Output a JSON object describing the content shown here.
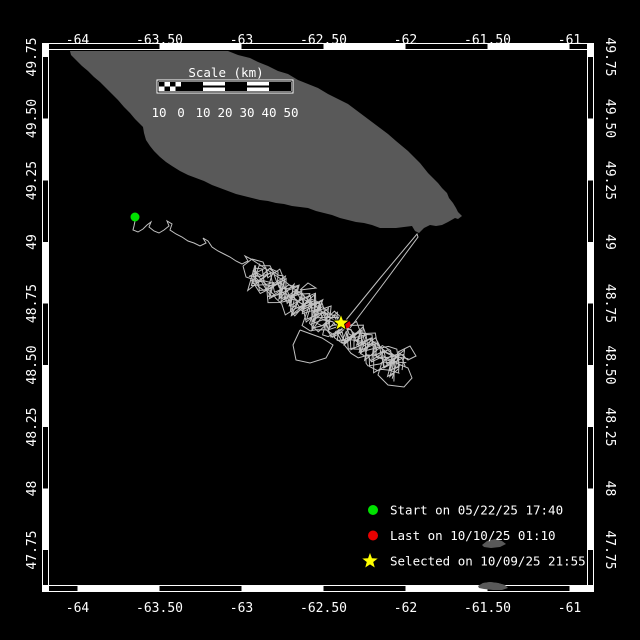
{
  "map_data": {
    "colors": {
      "background": "#000000",
      "land": "#595959",
      "track": "#c2c2c2",
      "frame_band": "#ffffff",
      "frame_seg": "#000000",
      "text": "#ffffff",
      "start_marker": "#00e100",
      "last_marker": "#e80000",
      "selected_marker": "#ffff00"
    },
    "frame": {
      "outer": {
        "x0": 42,
        "y0": 43,
        "x1": 594,
        "y1": 592
      },
      "inner": {
        "x0": 49,
        "y0": 50,
        "x1": 587,
        "y1": 585
      },
      "band_px": 7,
      "top_black_segments": [
        [
          49,
          159.5
        ],
        [
          241.5,
          323.5
        ],
        [
          405.5,
          487.5
        ],
        [
          569.5,
          587
        ]
      ],
      "bottom_black_segments": [
        [
          49,
          77.5
        ],
        [
          159.5,
          241.5
        ],
        [
          323.5,
          405.5
        ],
        [
          487.5,
          569.5
        ]
      ],
      "side_black_segments": [
        [
          57,
          118.5
        ],
        [
          180.5,
          242
        ],
        [
          303.5,
          365
        ],
        [
          427,
          488.5
        ],
        [
          550,
          585
        ]
      ]
    },
    "axis": {
      "x_ticks": [
        {
          "label": "-64",
          "x": 77.5
        },
        {
          "label": "-63.50",
          "x": 159.5
        },
        {
          "label": "-63",
          "x": 241.5
        },
        {
          "label": "-62.50",
          "x": 323.5
        },
        {
          "label": "-62",
          "x": 405.5
        },
        {
          "label": "-61.50",
          "x": 487.5
        },
        {
          "label": "-61",
          "x": 569.5
        }
      ],
      "y_ticks": [
        {
          "label": "49.75",
          "y": 57
        },
        {
          "label": "49.50",
          "y": 118.5
        },
        {
          "label": "49.25",
          "y": 180.5
        },
        {
          "label": "49",
          "y": 242
        },
        {
          "label": "48.75",
          "y": 303.5
        },
        {
          "label": "48.50",
          "y": 365
        },
        {
          "label": "48.25",
          "y": 427
        },
        {
          "label": "48",
          "y": 488.5
        },
        {
          "label": "47.75",
          "y": 550
        }
      ],
      "top_label_y": 44,
      "bottom_label_y": 612,
      "left_label_x": 36,
      "right_label_x": 606
    },
    "scalebar": {
      "title": "Scale (km)",
      "title_x": 226,
      "title_y": 77,
      "labels": [
        "10",
        "0",
        "10",
        "20",
        "30",
        "40",
        "50"
      ],
      "x0": 159,
      "step": 22,
      "bar_y": 81,
      "bar_h": 11,
      "label_y": 117
    },
    "legend": {
      "marker_x": 373,
      "text_x": 390,
      "y0": 510,
      "dy": 25.5,
      "items": [
        {
          "marker": "circle",
          "color": "#00e100",
          "label": "Start on 05/22/25 17:40"
        },
        {
          "marker": "circle",
          "color": "#e80000",
          "label": "Last on 10/10/25 01:10"
        },
        {
          "marker": "star",
          "color": "#ffff00",
          "label": "Selected on 10/09/25 21:55"
        }
      ]
    },
    "markers": {
      "start": {
        "x": 135,
        "y": 217,
        "r": 4.5
      },
      "last": {
        "x": 346,
        "y": 324,
        "r": 4.5
      },
      "selected": {
        "x": 341,
        "y": 323,
        "r": 9
      }
    },
    "island": [
      [
        70,
        51
      ],
      [
        228,
        51
      ],
      [
        238,
        55
      ],
      [
        250,
        58
      ],
      [
        258,
        62
      ],
      [
        268,
        66
      ],
      [
        278,
        71
      ],
      [
        288,
        74
      ],
      [
        298,
        80
      ],
      [
        308,
        84
      ],
      [
        318,
        88
      ],
      [
        328,
        94
      ],
      [
        338,
        99
      ],
      [
        348,
        104
      ],
      [
        356,
        110
      ],
      [
        364,
        116
      ],
      [
        372,
        122
      ],
      [
        380,
        128
      ],
      [
        388,
        134
      ],
      [
        396,
        141
      ],
      [
        402,
        146
      ],
      [
        408,
        151
      ],
      [
        414,
        157
      ],
      [
        420,
        163
      ],
      [
        424,
        168
      ],
      [
        428,
        173
      ],
      [
        433,
        178
      ],
      [
        438,
        183
      ],
      [
        442,
        188
      ],
      [
        447,
        193
      ],
      [
        449,
        198
      ],
      [
        453,
        203
      ],
      [
        456,
        208
      ],
      [
        458,
        212
      ],
      [
        462,
        216
      ],
      [
        458,
        219
      ],
      [
        455,
        218
      ],
      [
        448,
        222
      ],
      [
        442,
        225
      ],
      [
        436,
        226
      ],
      [
        430,
        225
      ],
      [
        424,
        228
      ],
      [
        419,
        233
      ],
      [
        415,
        231
      ],
      [
        412,
        226
      ],
      [
        404,
        227
      ],
      [
        396,
        228
      ],
      [
        388,
        228
      ],
      [
        380,
        228
      ],
      [
        372,
        225
      ],
      [
        364,
        223
      ],
      [
        356,
        222
      ],
      [
        348,
        220
      ],
      [
        340,
        218
      ],
      [
        332,
        215
      ],
      [
        324,
        213
      ],
      [
        316,
        211
      ],
      [
        308,
        208
      ],
      [
        300,
        207
      ],
      [
        292,
        206
      ],
      [
        284,
        204
      ],
      [
        276,
        203
      ],
      [
        268,
        201
      ],
      [
        260,
        200
      ],
      [
        252,
        198
      ],
      [
        244,
        196
      ],
      [
        236,
        194
      ],
      [
        228,
        191
      ],
      [
        220,
        188
      ],
      [
        212,
        185
      ],
      [
        204,
        181
      ],
      [
        196,
        178
      ],
      [
        188,
        175
      ],
      [
        180,
        171
      ],
      [
        172,
        166
      ],
      [
        166,
        162
      ],
      [
        160,
        157
      ],
      [
        154,
        151
      ],
      [
        150,
        146
      ],
      [
        146,
        140
      ],
      [
        144,
        133
      ],
      [
        143,
        127
      ],
      [
        139,
        123
      ],
      [
        135,
        119
      ],
      [
        130,
        113
      ],
      [
        124,
        107
      ],
      [
        118,
        100
      ],
      [
        112,
        94
      ],
      [
        106,
        88
      ],
      [
        100,
        82
      ],
      [
        94,
        77
      ],
      [
        88,
        71
      ],
      [
        82,
        66
      ],
      [
        76,
        60
      ],
      [
        71,
        55
      ]
    ],
    "islets": [
      [
        [
          482,
          545
        ],
        [
          487,
          541
        ],
        [
          495,
          539
        ],
        [
          502,
          541
        ],
        [
          506,
          544
        ],
        [
          500,
          547
        ],
        [
          491,
          548
        ],
        [
          484,
          547
        ]
      ],
      [
        [
          478,
          586
        ],
        [
          483,
          583
        ],
        [
          490,
          582
        ],
        [
          498,
          583
        ],
        [
          505,
          585
        ],
        [
          508,
          588
        ],
        [
          502,
          590
        ],
        [
          493,
          590
        ],
        [
          484,
          589
        ],
        [
          479,
          588
        ]
      ]
    ],
    "track_main": [
      [
        135,
        221
      ],
      [
        134,
        226
      ],
      [
        133,
        230
      ],
      [
        138,
        232
      ],
      [
        143,
        229
      ],
      [
        147,
        225
      ],
      [
        151,
        222
      ],
      [
        149,
        227
      ],
      [
        154,
        231
      ],
      [
        159,
        233
      ],
      [
        164,
        230
      ],
      [
        169,
        226
      ],
      [
        167,
        221
      ],
      [
        172,
        224
      ],
      [
        170,
        230
      ],
      [
        176,
        234
      ],
      [
        182,
        237
      ],
      [
        188,
        241
      ],
      [
        194,
        243
      ],
      [
        200,
        246
      ],
      [
        206,
        243
      ],
      [
        203,
        238
      ],
      [
        208,
        241
      ],
      [
        212,
        247
      ],
      [
        218,
        251
      ],
      [
        224,
        254
      ],
      [
        230,
        257
      ],
      [
        236,
        261
      ],
      [
        242,
        264
      ],
      [
        248,
        261
      ],
      [
        245,
        256
      ],
      [
        251,
        259
      ],
      [
        257,
        263
      ],
      [
        263,
        267
      ],
      [
        269,
        271
      ],
      [
        275,
        275
      ],
      [
        281,
        279
      ],
      [
        287,
        283
      ],
      [
        293,
        288
      ],
      [
        299,
        292
      ],
      [
        306,
        298
      ],
      [
        313,
        304
      ],
      [
        320,
        310
      ],
      [
        327,
        315
      ],
      [
        334,
        320
      ],
      [
        340,
        324
      ]
    ],
    "spike": [
      [
        346,
        320
      ],
      [
        381,
        277
      ],
      [
        417,
        234
      ],
      [
        418,
        237
      ],
      [
        384,
        283
      ],
      [
        350,
        328
      ]
    ],
    "loops": [
      [
        [
          300,
          330
        ],
        [
          293,
          345
        ],
        [
          296,
          360
        ],
        [
          310,
          363
        ],
        [
          326,
          358
        ],
        [
          333,
          345
        ],
        [
          322,
          338
        ]
      ],
      [
        [
          382,
          362
        ],
        [
          378,
          375
        ],
        [
          388,
          385
        ],
        [
          404,
          387
        ],
        [
          412,
          378
        ],
        [
          408,
          368
        ],
        [
          396,
          363
        ]
      ],
      [
        [
          398,
          352
        ],
        [
          408,
          360
        ],
        [
          416,
          356
        ],
        [
          410,
          346
        ]
      ],
      [
        [
          243,
          266
        ],
        [
          252,
          259
        ],
        [
          263,
          262
        ],
        [
          268,
          274
        ],
        [
          258,
          281
        ],
        [
          246,
          277
        ]
      ],
      [
        [
          300,
          290
        ],
        [
          308,
          283
        ],
        [
          316,
          288
        ]
      ]
    ],
    "cluster": {
      "cx": 327,
      "cy": 321,
      "angle_deg": 33,
      "half_len": 88,
      "half_wid": 14,
      "lines": 14,
      "points_per_line": 26,
      "seed": 987654321
    }
  }
}
